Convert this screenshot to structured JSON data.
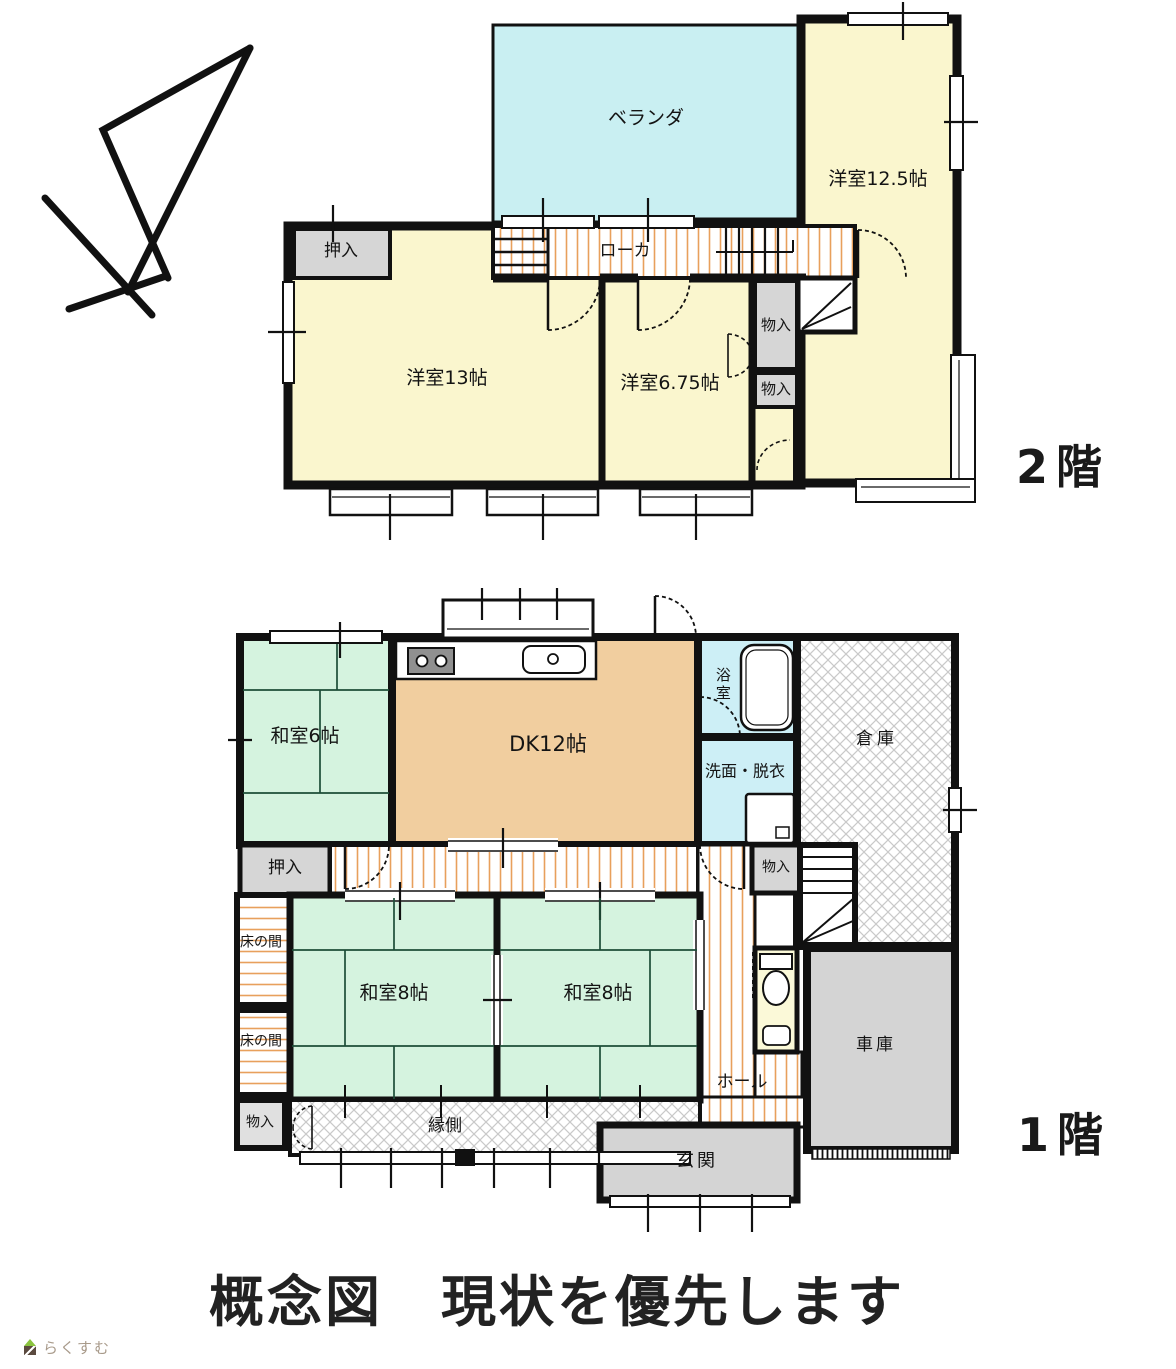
{
  "floor2": {
    "floor_label": "2階",
    "rooms": {
      "veranda": "ベランダ",
      "west125": "洋室12.5帖",
      "oshiire": "押入",
      "corridor": "ローカ",
      "west13": "洋室13帖",
      "west675": "洋室6.75帖",
      "storage_upper": "物入",
      "storage_lower": "物入"
    }
  },
  "floor1": {
    "floor_label": "1階",
    "rooms": {
      "washitsu6": "和室6帖",
      "dk": "DK12帖",
      "bath": "浴室",
      "washroom": "洗面・脱衣",
      "warehouse": "倉庫",
      "oshiire": "押入",
      "tokonoma_upper": "床の間",
      "tokonoma_lower": "床の間",
      "washitsu8_left": "和室8帖",
      "washitsu8_right": "和室8帖",
      "storage_bottom_left": "物入",
      "engawa": "縁側",
      "storage_stairs": "物入",
      "hall": "ホール",
      "garage": "車庫",
      "entrance": "玄関"
    }
  },
  "footer": {
    "title": "概念図　現状を優先します",
    "logo_text": "らくすむ"
  },
  "colors": {
    "wall": "#111111",
    "room_yellow": "#faf6ce",
    "veranda_cyan": "#c9eff2",
    "bath_cyan": "#cdeff6",
    "tatami_green": "#d5f3df",
    "dk_tan": "#f1ce9f",
    "closet_gray": "#d6d6d6",
    "toilet_yellow": "#fbf9d8",
    "stripe_orange": "#e8a05c",
    "hatch_gray": "#c9c9c9",
    "garage_gray": "#d4d4d4",
    "logo_text_color": "#a89a8a",
    "logo_green": "#8bc43f",
    "logo_brown": "#5b4a3f"
  }
}
